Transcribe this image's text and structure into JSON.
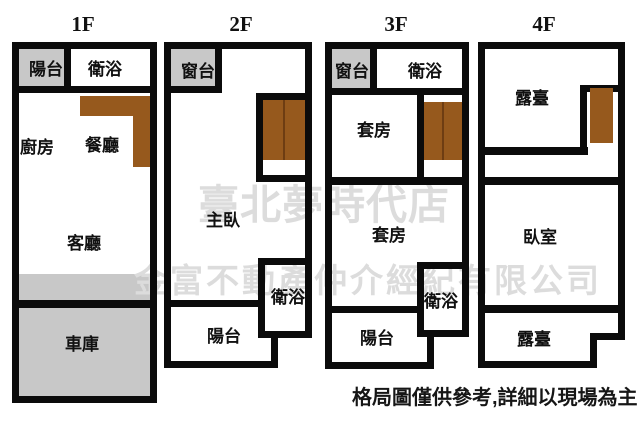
{
  "title": "四層樓透天格局圖",
  "floors": [
    {
      "label": "1F",
      "rooms": {
        "balcony": "陽台",
        "bath": "衛浴",
        "kitchen": "廚房",
        "dining": "餐廳",
        "living": "客廳",
        "garage": "車庫"
      }
    },
    {
      "label": "2F",
      "rooms": {
        "window_bay": "窗台",
        "master_bedroom": "主臥",
        "bath": "衛浴",
        "balcony": "陽台"
      }
    },
    {
      "label": "3F",
      "rooms": {
        "window_bay": "窗台",
        "bath_upper": "衛浴",
        "suite_upper": "套房",
        "suite_lower": "套房",
        "bath_lower": "衛浴",
        "balcony": "陽台"
      }
    },
    {
      "label": "4F",
      "rooms": {
        "terrace_upper": "露臺",
        "bedroom": "臥室",
        "terrace_lower": "露臺"
      }
    }
  ],
  "watermark": {
    "line1": "臺北夢時代店",
    "line2": "金富不動產仲介經紀有限公司"
  },
  "disclaimer": "格局圖僅供參考,詳細以現場為主",
  "colors": {
    "background": "#ffffff",
    "wall": "#0b0b0b",
    "gray_fill": "#c8c8c8",
    "wood_brown": "#96591d",
    "wood_divider": "#6e3d12",
    "watermark": "#dcdcdc"
  }
}
